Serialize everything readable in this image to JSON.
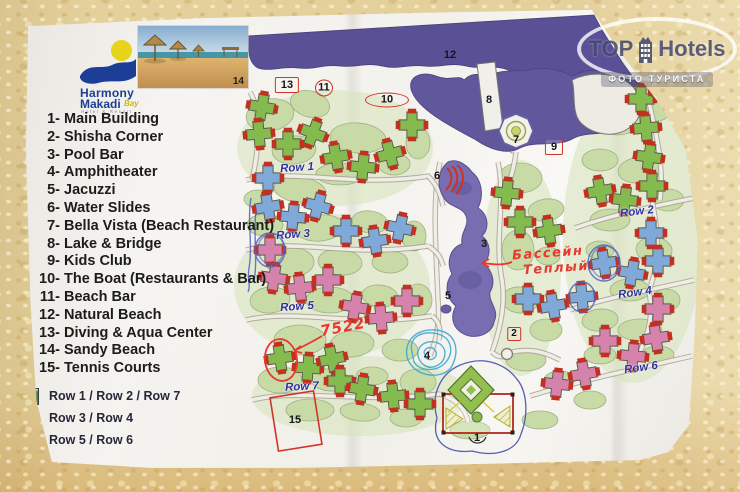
{
  "watermark": {
    "brand_top": "TOP",
    "brand_hotels": "Hotels",
    "tagline": "ФОТО ТУРИСТА"
  },
  "hotel_logo": {
    "line1": "Harmony",
    "line2": "Makadi",
    "script": "Bay",
    "tagline": "Hotel & Resort"
  },
  "photo_inset": {
    "label": "14"
  },
  "poi_list": {
    "items": [
      {
        "num": "1-",
        "label": "Main Building"
      },
      {
        "num": "2-",
        "label": "Shisha Corner"
      },
      {
        "num": "3-",
        "label": "Pool Bar"
      },
      {
        "num": "4-",
        "label": "Amphitheater"
      },
      {
        "num": "5-",
        "label": "Jacuzzi"
      },
      {
        "num": "6-",
        "label": "Water Slides"
      },
      {
        "num": "7-",
        "label": "Bella Vista (Beach Restaurant)"
      },
      {
        "num": "8-",
        "label": "Lake & Bridge"
      },
      {
        "num": "9-",
        "label": "Kids Club"
      },
      {
        "num": "10-",
        "label": "The Boat (Restaurants & Bar)"
      },
      {
        "num": "11-",
        "label": "Beach Bar"
      },
      {
        "num": "12-",
        "label": "Natural Beach"
      },
      {
        "num": "13-",
        "label": "Diving & Aqua Center"
      },
      {
        "num": "14-",
        "label": "Sandy Beach"
      },
      {
        "num": "15-",
        "label": "Tennis Courts"
      }
    ]
  },
  "row_color_legend": {
    "items": [
      {
        "color": "#79b548",
        "label": "Row 1 / Row 2 / Row 7"
      },
      {
        "color": "#76a4d8",
        "label": "Row 3 / Row 4"
      },
      {
        "color": "#d97cad",
        "label": "Row 5 / Row 6"
      }
    ]
  },
  "map": {
    "row_labels": [
      {
        "text": "Row 1",
        "x": 297,
        "y": 168,
        "rot": -4
      },
      {
        "text": "Row 2",
        "x": 637,
        "y": 212,
        "rot": -7
      },
      {
        "text": "Row 3",
        "x": 293,
        "y": 235,
        "rot": -4
      },
      {
        "text": "Row 4",
        "x": 635,
        "y": 293,
        "rot": -8
      },
      {
        "text": "Row 5",
        "x": 297,
        "y": 307,
        "rot": -4
      },
      {
        "text": "Row 6",
        "x": 641,
        "y": 368,
        "rot": -8
      },
      {
        "text": "Row 7",
        "x": 302,
        "y": 387,
        "rot": -3
      }
    ],
    "markers": [
      {
        "id": "12",
        "shape": "plain",
        "x": 450,
        "y": 55
      },
      {
        "id": "13",
        "shape": "rect",
        "x": 287,
        "y": 85
      },
      {
        "id": "11",
        "shape": "circle",
        "x": 324,
        "y": 88
      },
      {
        "id": "10",
        "shape": "oval",
        "x": 387,
        "y": 100
      },
      {
        "id": "8",
        "shape": "plain",
        "x": 489,
        "y": 100
      },
      {
        "id": "7",
        "shape": "plain",
        "x": 516,
        "y": 140
      },
      {
        "id": "9",
        "shape": "rect",
        "x": 554,
        "y": 147
      },
      {
        "id": "6",
        "shape": "plain",
        "x": 437,
        "y": 176
      },
      {
        "id": "3",
        "shape": "plain",
        "x": 484,
        "y": 244
      },
      {
        "id": "5",
        "shape": "plain",
        "x": 448,
        "y": 296
      },
      {
        "id": "4",
        "shape": "plain",
        "x": 427,
        "y": 356
      },
      {
        "id": "2",
        "shape": "rect-small",
        "x": 514,
        "y": 334
      },
      {
        "id": "1",
        "shape": "plain",
        "x": 477,
        "y": 438
      },
      {
        "id": "15",
        "shape": "plain",
        "x": 295,
        "y": 420
      }
    ],
    "handwritten": {
      "pool_note_line1": "Бассейн",
      "pool_note_line2": "Теплый",
      "room_number": "7522"
    },
    "building_colors": {
      "green": "#84bb4f",
      "blue": "#7fa9d9",
      "pink": "#d583ad"
    },
    "buildings": [
      {
        "x": 262,
        "y": 107,
        "c": "green",
        "r": 10
      },
      {
        "x": 259,
        "y": 134,
        "c": "green",
        "r": -5
      },
      {
        "x": 288,
        "y": 144,
        "c": "green",
        "r": 0
      },
      {
        "x": 313,
        "y": 133,
        "c": "green",
        "r": 20
      },
      {
        "x": 336,
        "y": 157,
        "c": "green",
        "r": -10
      },
      {
        "x": 363,
        "y": 167,
        "c": "green",
        "r": 5
      },
      {
        "x": 390,
        "y": 154,
        "c": "green",
        "r": -15
      },
      {
        "x": 412,
        "y": 125,
        "c": "green",
        "r": 0
      },
      {
        "x": 507,
        "y": 193,
        "c": "green",
        "r": 5
      },
      {
        "x": 520,
        "y": 222,
        "c": "green",
        "r": 0
      },
      {
        "x": 549,
        "y": 231,
        "c": "green",
        "r": -8
      },
      {
        "x": 641,
        "y": 99,
        "c": "green",
        "r": 0
      },
      {
        "x": 664,
        "y": 90,
        "c": "green",
        "r": -8
      },
      {
        "x": 646,
        "y": 128,
        "c": "green",
        "r": -5
      },
      {
        "x": 649,
        "y": 157,
        "c": "green",
        "r": 8
      },
      {
        "x": 652,
        "y": 186,
        "c": "green",
        "r": 0
      },
      {
        "x": 600,
        "y": 191,
        "c": "green",
        "r": -10
      },
      {
        "x": 625,
        "y": 200,
        "c": "green",
        "r": 6
      },
      {
        "x": 280,
        "y": 358,
        "c": "green",
        "r": -8
      },
      {
        "x": 308,
        "y": 368,
        "c": "green",
        "r": 4
      },
      {
        "x": 332,
        "y": 359,
        "c": "green",
        "r": -12
      },
      {
        "x": 340,
        "y": 381,
        "c": "green",
        "r": 0
      },
      {
        "x": 362,
        "y": 389,
        "c": "green",
        "r": 8
      },
      {
        "x": 393,
        "y": 396,
        "c": "green",
        "r": -5
      },
      {
        "x": 420,
        "y": 404,
        "c": "green",
        "r": 0
      },
      {
        "x": 268,
        "y": 178,
        "c": "blue",
        "r": 0
      },
      {
        "x": 268,
        "y": 207,
        "c": "blue",
        "r": -10
      },
      {
        "x": 293,
        "y": 217,
        "c": "blue",
        "r": 5
      },
      {
        "x": 318,
        "y": 206,
        "c": "blue",
        "r": 15
      },
      {
        "x": 346,
        "y": 231,
        "c": "blue",
        "r": 0
      },
      {
        "x": 375,
        "y": 241,
        "c": "blue",
        "r": -8
      },
      {
        "x": 400,
        "y": 228,
        "c": "blue",
        "r": 12
      },
      {
        "x": 528,
        "y": 299,
        "c": "blue",
        "r": 0
      },
      {
        "x": 553,
        "y": 306,
        "c": "blue",
        "r": -10
      },
      {
        "x": 651,
        "y": 233,
        "c": "blue",
        "r": 0
      },
      {
        "x": 658,
        "y": 261,
        "c": "blue",
        "r": 0
      },
      {
        "x": 632,
        "y": 273,
        "c": "blue",
        "r": 10
      },
      {
        "x": 604,
        "y": 263,
        "c": "blue",
        "r": -8
      },
      {
        "x": 582,
        "y": 297,
        "c": "blue",
        "r": -5
      },
      {
        "x": 270,
        "y": 250,
        "c": "pink",
        "r": 0
      },
      {
        "x": 274,
        "y": 278,
        "c": "pink",
        "r": 8
      },
      {
        "x": 300,
        "y": 288,
        "c": "pink",
        "r": -6
      },
      {
        "x": 328,
        "y": 280,
        "c": "pink",
        "r": 0
      },
      {
        "x": 355,
        "y": 307,
        "c": "pink",
        "r": 10
      },
      {
        "x": 381,
        "y": 318,
        "c": "pink",
        "r": -5
      },
      {
        "x": 407,
        "y": 301,
        "c": "pink",
        "r": 0
      },
      {
        "x": 658,
        "y": 309,
        "c": "pink",
        "r": 0
      },
      {
        "x": 656,
        "y": 338,
        "c": "pink",
        "r": -8
      },
      {
        "x": 633,
        "y": 356,
        "c": "pink",
        "r": 5
      },
      {
        "x": 605,
        "y": 341,
        "c": "pink",
        "r": 0
      },
      {
        "x": 584,
        "y": 374,
        "c": "pink",
        "r": -10
      },
      {
        "x": 557,
        "y": 384,
        "c": "pink",
        "r": 6
      }
    ]
  }
}
